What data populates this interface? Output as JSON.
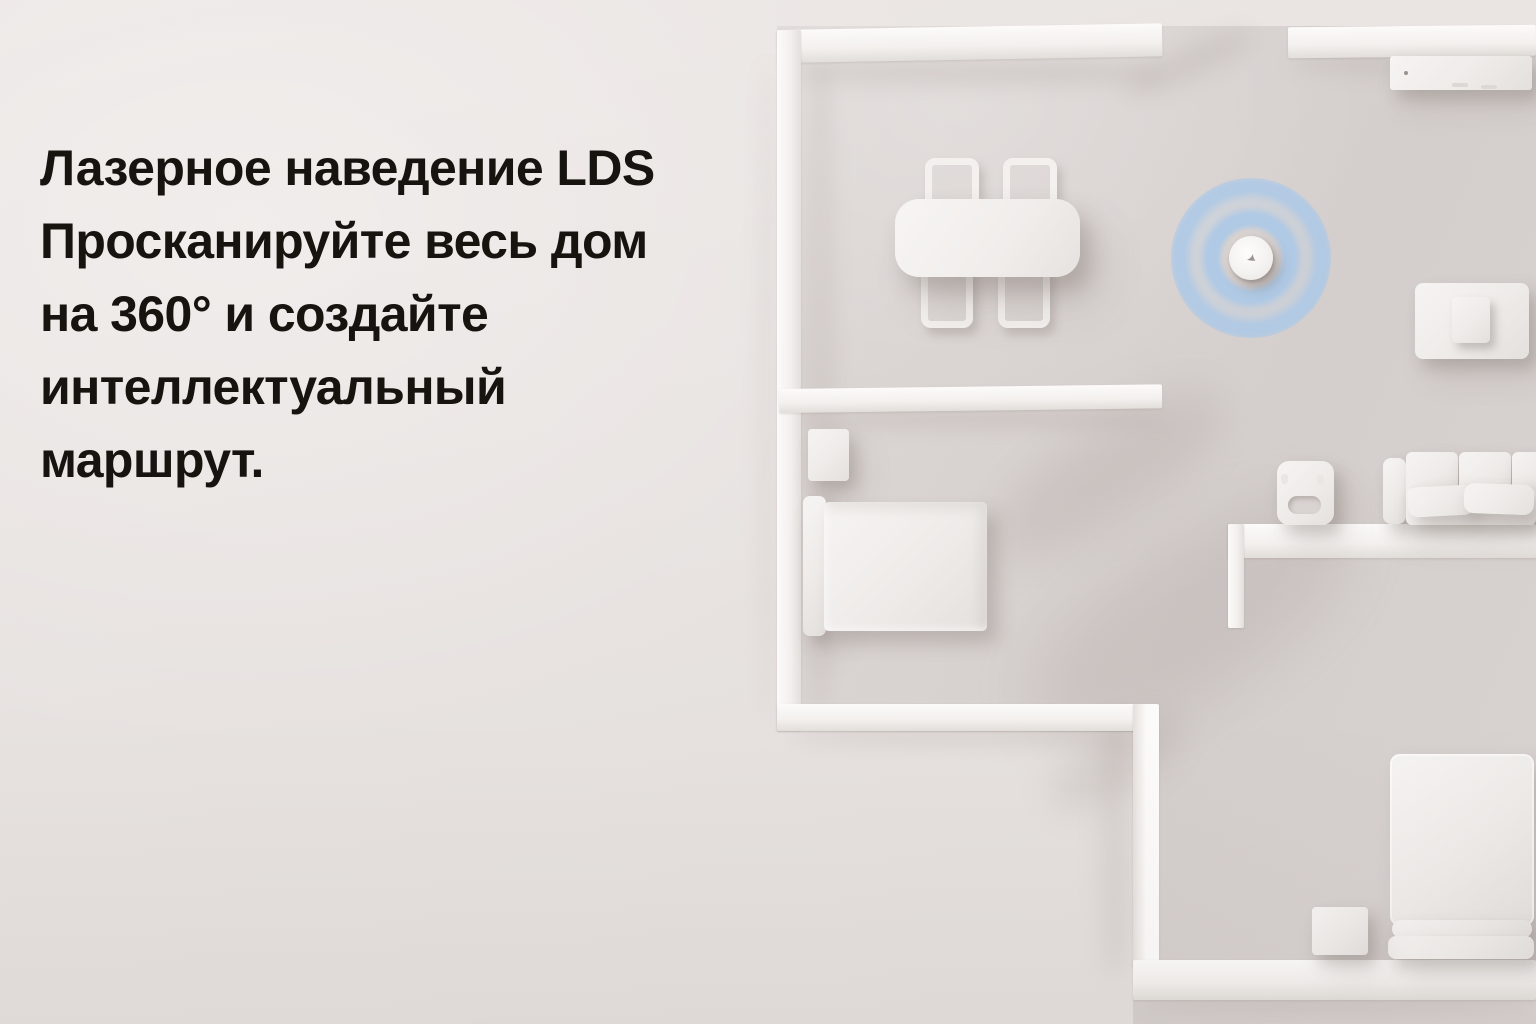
{
  "hero": {
    "full_text": "Лазерное наведение LDS Просканируйте весь дом на 360° и создайте интеллектуальный маршрут.",
    "lines": [
      "Лазерное наведение LDS",
      "Просканируйте весь дом",
      "на 360° и создайте",
      "интеллектуальный",
      "маршрут."
    ]
  },
  "colors": {
    "background": "#e9e4e2",
    "headline_text": "#17130f",
    "radar_blue": "#a9c8e9",
    "wall_white": "#faf8f6",
    "floor_shade": "#d7d1cf"
  },
  "icons": {
    "robot_logo": "bird-swoosh"
  }
}
